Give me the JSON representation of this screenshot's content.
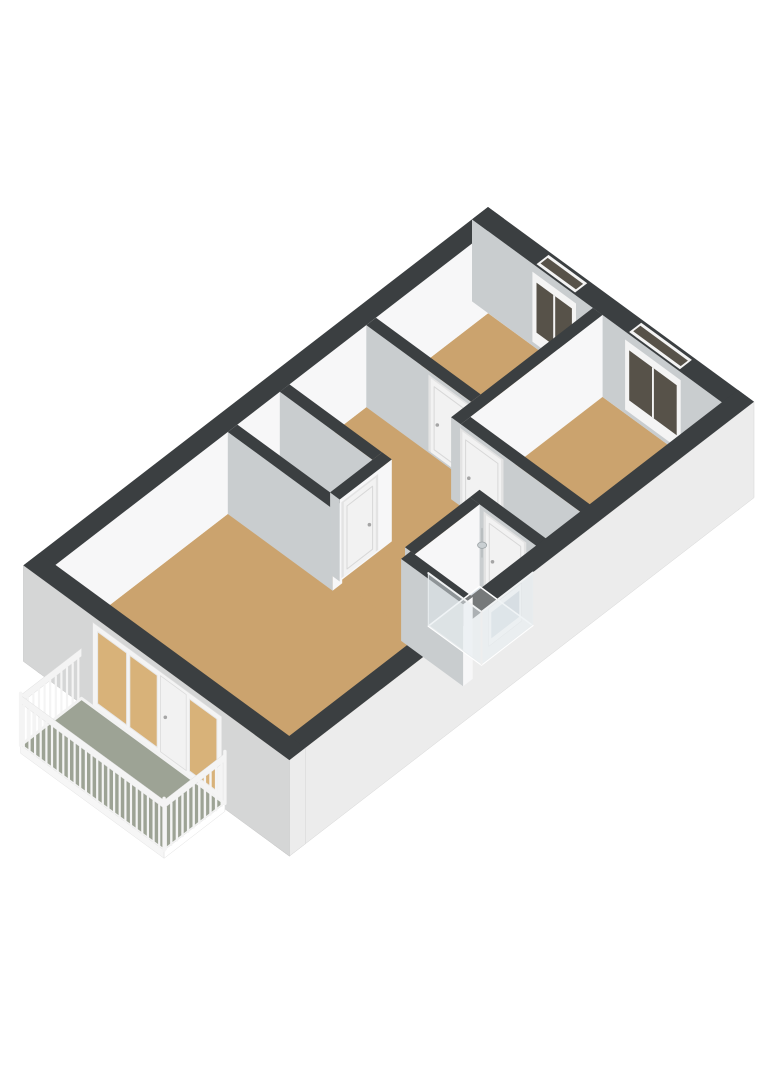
{
  "scene": {
    "description": "3D axonometric floor plan of an apartment storey with two bedrooms, hallway, WC, bathroom with shower, living room and a balcony",
    "canvas": {
      "width": 768,
      "height": 1086
    },
    "background": "#ffffff"
  },
  "projection": {
    "origin": [
      488,
      207
    ],
    "u": [
      -0.801,
      0.618
    ],
    "v": [
      0.806,
      0.59
    ],
    "floor_drop": 82,
    "ground_drop": 96
  },
  "palette": {
    "wall_top": "#3b3f41",
    "wall_face_bright": "#f7f7f8",
    "wall_face_shade": "#c9cdcf",
    "ext_face_se": "#ececec",
    "ext_face_sw": "#d5d6d6",
    "floor_wood": "#cba36e",
    "floor_wood_lit": "#d8b279",
    "floor_tile": "#ccd6de",
    "balcony_floor": "#9da395",
    "glass_dark": "#575249",
    "glass_pale": "#ccd3d8",
    "frame_white": "#f4f4f4",
    "door_white": "#f2f2f2",
    "door_edge": "#d8d8d8",
    "railing_white": "#f4f4f4",
    "shower_glass_fill": "rgba(226,233,237,0.5)",
    "shower_glass_edge": "#e9edef",
    "metal_gray": "#b9bec0"
  },
  "plan": {
    "outer_length": 580,
    "outer_width": 330,
    "outer_wall_thickness": 20,
    "inner_wall_thickness": 12
  },
  "rooms": [
    {
      "name": "hallway",
      "floor": "wood",
      "rect": [
        160,
        20,
        345,
        312
      ]
    },
    {
      "name": "wc",
      "floor": "wood",
      "rect": [
        268,
        20,
        345,
        147
      ]
    },
    {
      "name": "bathroom",
      "floor": "tile",
      "rect": [
        240,
        228,
        333,
        312
      ]
    },
    {
      "name": "bedroom-1",
      "floor": "wood",
      "rect": [
        20,
        20,
        172,
        162
      ]
    },
    {
      "name": "bedroom-2",
      "floor": "wood",
      "rect": [
        20,
        150,
        197,
        312
      ]
    },
    {
      "name": "living-room",
      "floor": "wood",
      "rect": [
        333,
        20,
        562,
        312
      ]
    }
  ],
  "walls": [
    {
      "name": "wall-outer-nw",
      "rect": [
        0,
        0,
        580,
        20
      ],
      "faceB": "bright",
      "faceA": "ext_sw",
      "faceBH": "floor",
      "faceAH": "ground",
      "trimB": 18
    },
    {
      "name": "wall-outer-ne",
      "rect": [
        0,
        0,
        20,
        330
      ],
      "faceB": "ext_se",
      "faceA": "shade",
      "faceBH": "ground",
      "faceAH": "floor",
      "trimA": 18
    },
    {
      "name": "wall-bed1-sw",
      "rect": [
        160,
        20,
        172,
        150
      ]
    },
    {
      "name": "wall-bed1-bed2",
      "rect": [
        20,
        150,
        197,
        162
      ]
    },
    {
      "name": "wall-wc-ne",
      "rect": [
        268,
        20,
        280,
        135
      ]
    },
    {
      "name": "wall-bed2-sw",
      "rect": [
        185,
        162,
        197,
        312
      ]
    },
    {
      "name": "wall-living-ne-north",
      "rect": [
        333,
        20,
        345,
        150
      ]
    },
    {
      "name": "wall-wc-se",
      "rect": [
        268,
        135,
        333,
        147
      ]
    },
    {
      "name": "wall-bath-ne",
      "rect": [
        240,
        228,
        252,
        312
      ]
    },
    {
      "name": "wall-bath-nw",
      "rect": [
        252,
        228,
        333,
        240
      ]
    },
    {
      "name": "wall-outer-se",
      "rect": [
        0,
        310,
        580,
        330
      ],
      "faceB": "ext_se",
      "faceA": "ext_sw",
      "faceBH": "ground",
      "faceAH": "ground"
    },
    {
      "name": "wall-living-ne-south",
      "rect": [
        333,
        235,
        345,
        312
      ]
    },
    {
      "name": "wall-outer-sw",
      "rect": [
        560,
        0,
        580,
        330
      ],
      "faceB": "ext_se",
      "faceA": "ext_sw",
      "faceBH": "ground",
      "faceAH": "ground"
    }
  ],
  "windows": {
    "ne_wall": [
      {
        "name": "bedroom-1-window",
        "b": [
          78,
          126
        ]
      },
      {
        "name": "bedroom-2-window",
        "b": [
          193,
          256
        ]
      }
    ],
    "se_wall": [
      {
        "name": "bathroom-window",
        "a": [
          293,
          328
        ]
      }
    ]
  },
  "doors": [
    {
      "name": "bedroom-1-door",
      "plane": "a",
      "at": 172,
      "range": [
        100,
        148
      ],
      "host": "wall-bed1-sw"
    },
    {
      "name": "bedroom-2-door",
      "plane": "a",
      "at": 197,
      "range": [
        164,
        212
      ],
      "host": "wall-bed2-sw"
    },
    {
      "name": "wc-door",
      "plane": "b",
      "at": 147,
      "range": [
        288,
        328
      ],
      "host": "wall-wc-se"
    },
    {
      "name": "bathroom-door",
      "plane": "a",
      "at": 252,
      "range": [
        248,
        295
      ],
      "host": "wall-bath-ne"
    }
  ],
  "fixtures": {
    "toilet": {
      "tank_rect": [
        300,
        24,
        330,
        40
      ],
      "bowl_center": [
        315,
        52
      ],
      "bowl_radius": [
        11,
        7.5
      ]
    },
    "shower": {
      "rect": [
        253,
        241,
        317,
        307
      ],
      "glass_top": 28,
      "head_at": [
        262,
        253
      ]
    }
  },
  "balcony": {
    "rect": [
      582,
      74,
      658,
      252
    ],
    "floor_drop": 88,
    "rail_top": 38,
    "rail_bottom": 46,
    "post_step": 7,
    "fascia_depth": 8
  },
  "sw_glazing": {
    "frame": {
      "b": [
        86,
        246
      ],
      "h": [
        6,
        90
      ]
    },
    "panes": [
      {
        "name": "sliding-door-pane-1",
        "b": [
          92,
          128
        ]
      },
      {
        "name": "sliding-door-pane-2",
        "b": [
          132,
          166
        ]
      },
      {
        "name": "balcony-window-pane",
        "b": [
          206,
          240
        ]
      }
    ],
    "door_panel": {
      "name": "balcony-door-panel",
      "b": [
        170,
        202
      ]
    }
  }
}
